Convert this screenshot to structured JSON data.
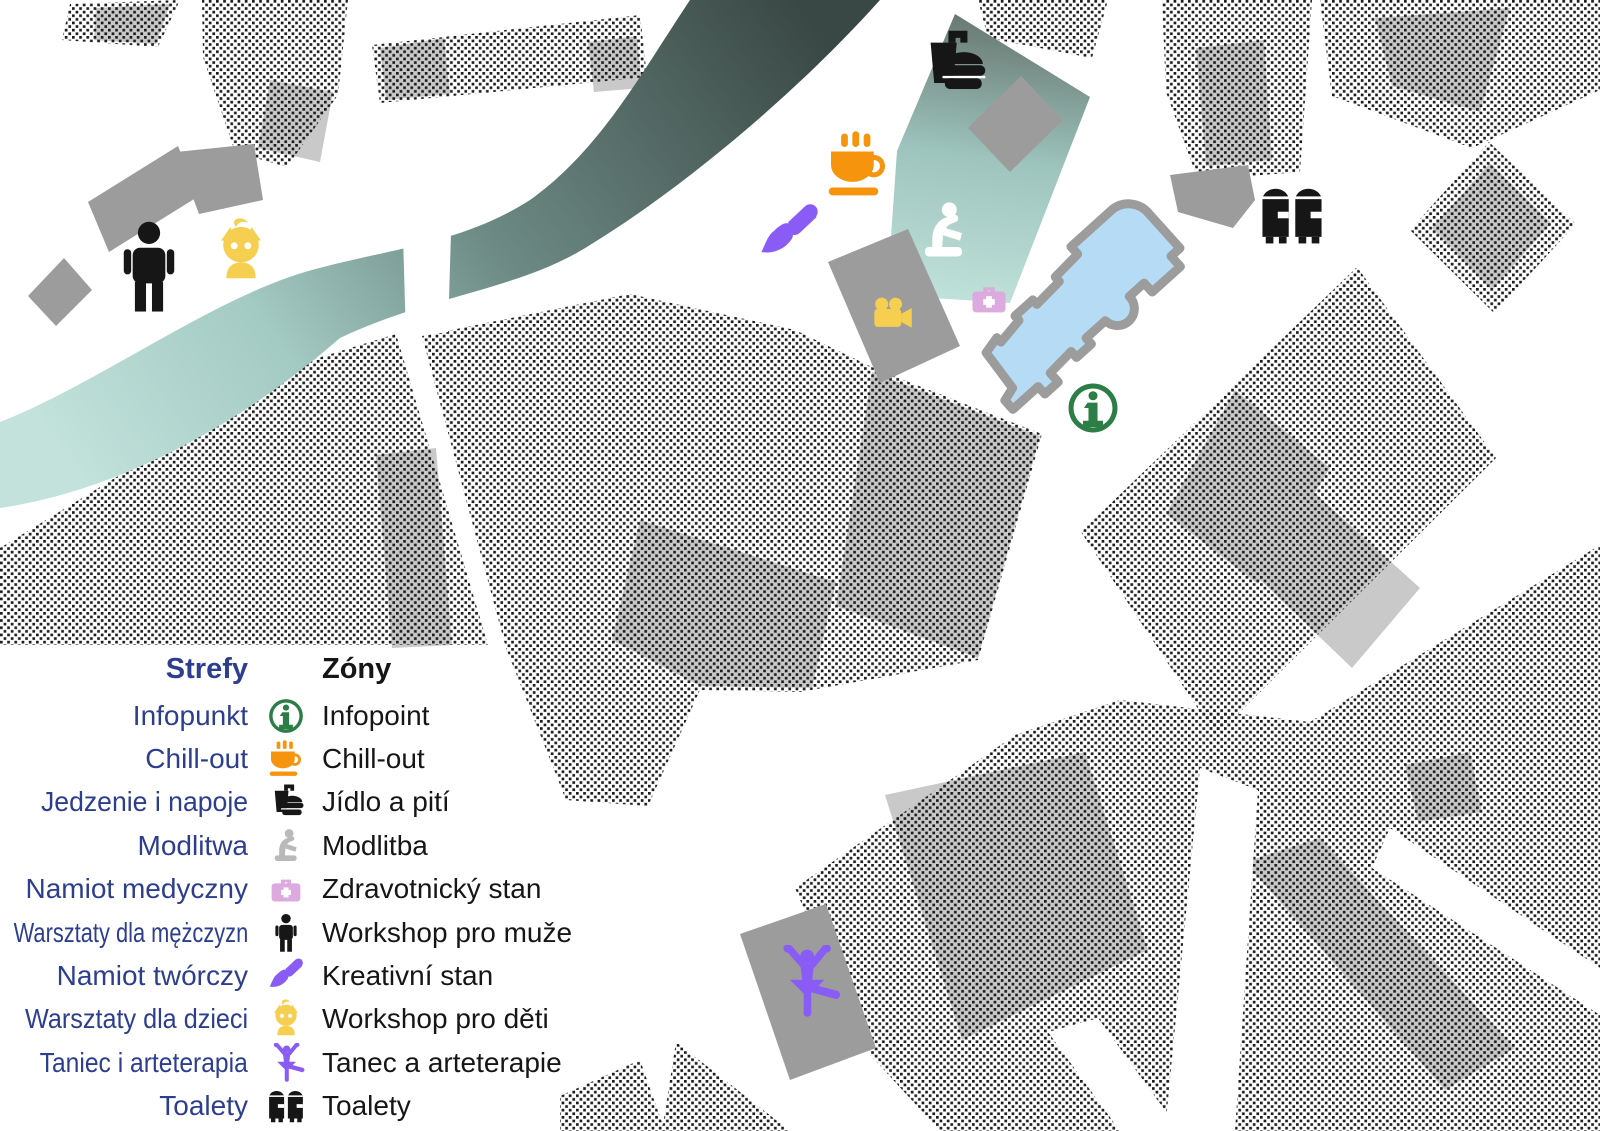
{
  "title": "Festival zones map (Strefy / Zóny)",
  "colors": {
    "accent_blue": "#2d3e8f",
    "text_black": "#161616",
    "halftone_dot": "#1d1d1d",
    "building_gray": "#9c9c9c",
    "building_in_block_gray": "#c9c9c9",
    "river_dark": "#3a4845",
    "river_light": "#c2e2db",
    "zone_teal": "#9dc4bd",
    "church_fill": "#b5dcf4",
    "church_outline": "#9c9c9c",
    "orange": "#f7940d",
    "yellow": "#f6cf50",
    "purple": "#8a5cf6",
    "pink": "#dcaade",
    "green": "#2d7d46",
    "white": "#ffffff"
  },
  "legend": {
    "heading": {
      "pl": "Strefy",
      "cz": "Zóny"
    },
    "rows": [
      {
        "pl": "Infopunkt",
        "cz": "Infopoint",
        "icon": "info-icon",
        "color": "#2d7d46"
      },
      {
        "pl": "Chill-out",
        "cz": "Chill-out",
        "icon": "coffee-cup-icon",
        "color": "#f7940d"
      },
      {
        "pl": "Jedzenie i napoje",
        "cz": "Jídlo a pití",
        "icon": "food-drink-icon",
        "color": "#161616"
      },
      {
        "pl": "Modlitwa",
        "cz": "Modlitba",
        "icon": "praying-person-icon",
        "color": "#b9b9b9"
      },
      {
        "pl": "Namiot medyczny",
        "cz": "Zdravotnický stan",
        "icon": "first-aid-kit-icon",
        "color": "#dcaade"
      },
      {
        "pl": "Warsztaty dla mężczyzn",
        "cz": "Workshop pro muže",
        "icon": "man-icon",
        "color": "#161616"
      },
      {
        "pl": "Namiot twórczy",
        "cz": "Kreativní stan",
        "icon": "paintbrush-icon",
        "color": "#8a5cf6"
      },
      {
        "pl": "Warsztaty dla dzieci",
        "cz": "Workshop pro děti",
        "icon": "child-icon",
        "color": "#f6cf50"
      },
      {
        "pl": "Taniec i arteterapia",
        "cz": "Tanec a arteterapie",
        "icon": "dancer-icon",
        "color": "#8a5cf6"
      },
      {
        "pl": "Toalety",
        "cz": "Toalety",
        "icon": "toilets-icon",
        "color": "#161616"
      }
    ]
  },
  "map": {
    "markers": [
      {
        "name": "workshop-men",
        "icon": "man-icon",
        "x": 149,
        "y": 267,
        "size": 95,
        "color": "#161616"
      },
      {
        "name": "workshop-kids",
        "icon": "child-icon",
        "x": 241,
        "y": 251,
        "size": 67,
        "color": "#f6cf50"
      },
      {
        "name": "food-and-drink",
        "icon": "food-drink-icon",
        "x": 952,
        "y": 64,
        "size": 76,
        "color": "#161616"
      },
      {
        "name": "chill-out",
        "icon": "coffee-cup-icon",
        "x": 858,
        "y": 165,
        "size": 72,
        "color": "#f7940d"
      },
      {
        "name": "creative-tent",
        "icon": "paintbrush-icon",
        "x": 789,
        "y": 234,
        "size": 68,
        "color": "#8a5cf6"
      },
      {
        "name": "prayer-zone",
        "icon": "praying-person-icon",
        "x": 944,
        "y": 231,
        "size": 68,
        "color": "#ffffff"
      },
      {
        "name": "medical-tent",
        "icon": "first-aid-kit-icon",
        "x": 989,
        "y": 298,
        "size": 46,
        "color": "#dcaade"
      },
      {
        "name": "video-zone",
        "icon": "video-camera-icon",
        "x": 889,
        "y": 313,
        "size": 52,
        "color": "#f6cf50"
      },
      {
        "name": "infopoint",
        "icon": "info-icon",
        "x": 1093,
        "y": 408,
        "size": 58,
        "color": "#2d7d46"
      },
      {
        "name": "toilets",
        "icon": "toilets-icon",
        "x": 1292,
        "y": 215,
        "size": 70,
        "color": "#161616"
      },
      {
        "name": "dance-arttherapy",
        "icon": "dancer-icon",
        "x": 806,
        "y": 982,
        "size": 74,
        "color": "#8a5cf6"
      }
    ]
  }
}
